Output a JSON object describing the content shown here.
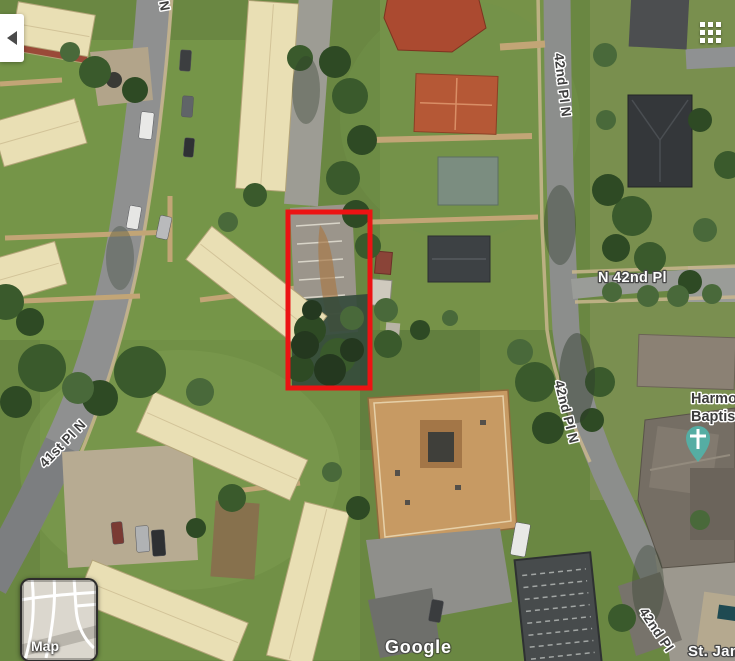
{
  "controls": {
    "back_button": {
      "icon": "back-arrow"
    },
    "apps_grid": {
      "icon": "grid-3x3"
    },
    "map_toggle_label": "Map"
  },
  "attribution": {
    "watermark": "Google"
  },
  "streets": {
    "partial_top_n": "N",
    "top_vertical": "42nd Pl N",
    "right_horizontal": "N 42nd Pl",
    "mid_vertical": "42nd Pl N",
    "left_diagonal": "41st Pl N",
    "bottom_diagonal": "42nd Pl",
    "bottom_right_place": "St. James"
  },
  "poi": {
    "harmony_line1": "Harmony",
    "harmony_line2": "Baptist",
    "pin_icon": "church-cross-pin"
  },
  "colors": {
    "parcel_red": "#ec1313",
    "church_pin": "#55ada3"
  }
}
